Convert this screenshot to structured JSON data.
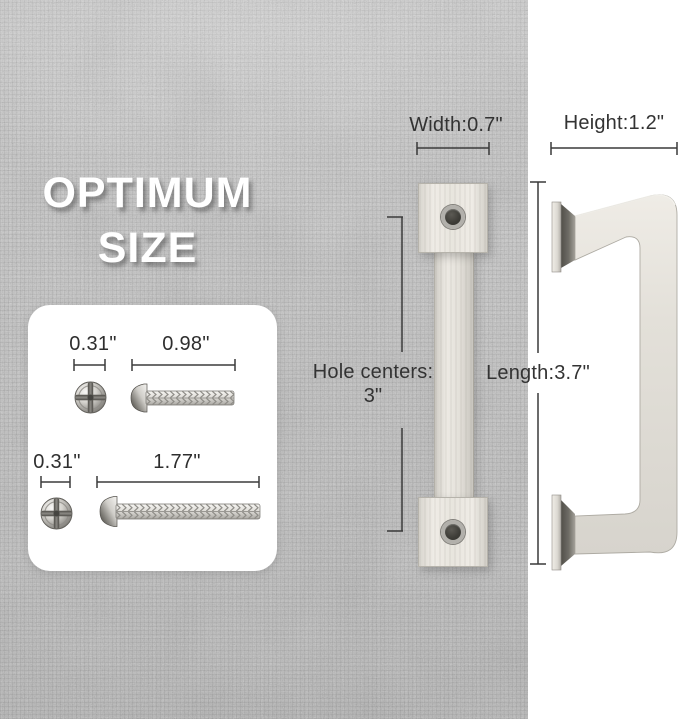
{
  "headline": {
    "line1": "OPTIMUM",
    "line2": "SIZE"
  },
  "screw_card": {
    "row1": {
      "head_diameter": "0.31\"",
      "screw_length": "0.98\""
    },
    "row2": {
      "head_diameter": "0.31\"",
      "screw_length": "1.77\""
    }
  },
  "front_view": {
    "width_label": "Width:0.7\"",
    "hole_centers_line1": "Hole centers:",
    "hole_centers_line2": "3\""
  },
  "side_view": {
    "height_label": "Height:1.2\"",
    "length_label": "Length:3.7\""
  },
  "icons": {
    "screw_head_top_view": "phillips-pan-head",
    "screw_side_view_short": "machine-screw-short",
    "screw_side_view_long": "machine-screw-long",
    "handle_front_view": "square-bar-pull-front",
    "handle_side_view": "square-bar-pull-side"
  },
  "colors": {
    "fabric_background": "#c6c6c6",
    "right_panel": "#ffffff",
    "headline_text": "#ffffff",
    "dimension_text": "#333333",
    "handle_finish": "#e8e5de",
    "card_background": "#ffffff"
  }
}
